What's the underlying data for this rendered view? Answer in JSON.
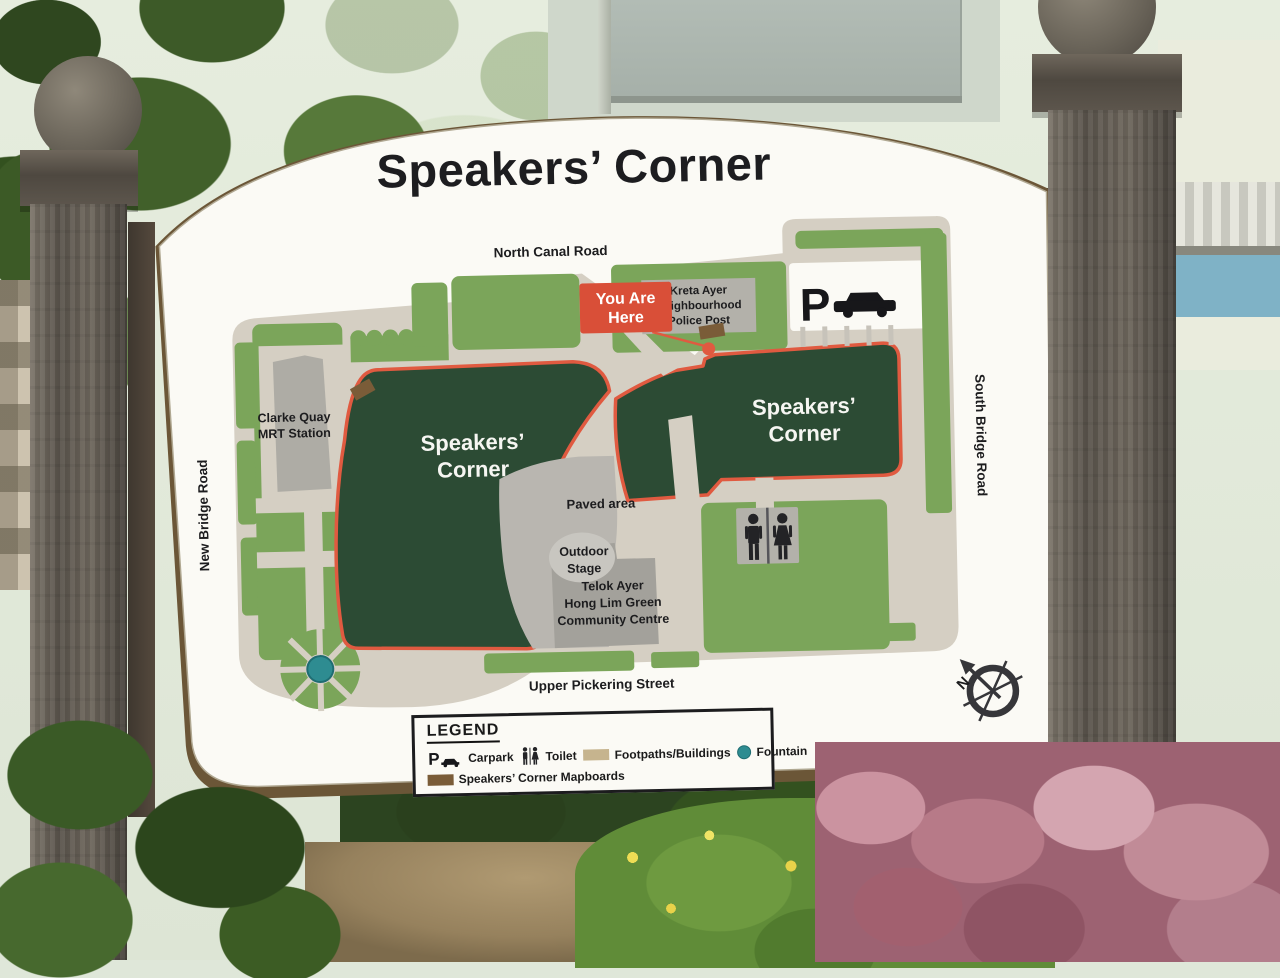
{
  "theme": {
    "paper": "#fbfaf5",
    "beige": "#d5cfc3",
    "lawn": "#7ba55a",
    "field": "#2c4b34",
    "route": "#e05a40",
    "teal": "#2e8c91",
    "paved": "#b9b6b0",
    "bldg": "#a3a19b",
    "greybox": "#b3b1aa",
    "brown": "#7a5c38",
    "tan": "#c6b48e",
    "ink": "#1d1d20",
    "rim": "#6b5637"
  },
  "sign": {
    "title": "Speakers’ Corner"
  },
  "map": {
    "roads": {
      "north": "North Canal Road",
      "west": "New Bridge Road",
      "east": "South Bridge Road",
      "south": "Upper Pickering Street"
    },
    "you_are_here": {
      "line1": "You Are",
      "line2": "Here"
    },
    "police_post": {
      "line1": "Kreta Ayer",
      "line2": "Neighbourhood",
      "line3": "Police Post"
    },
    "mrt": {
      "line1": "Clarke Quay",
      "line2": "MRT Station"
    },
    "field_left": {
      "line1": "Speakers’",
      "line2": "Corner"
    },
    "field_right": {
      "line1": "Speakers’",
      "line2": "Corner"
    },
    "paved_area": "Paved area",
    "stage": {
      "line1": "Outdoor",
      "line2": "Stage"
    },
    "community_centre": {
      "line1": "Telok Ayer",
      "line2": "Hong Lim Green",
      "line3": "Community Centre"
    },
    "carpark_letter": "P",
    "compass_n": "N"
  },
  "legend": {
    "heading": "LEGEND",
    "items": [
      {
        "label": "Carpark"
      },
      {
        "label": "Toilet"
      },
      {
        "label": "Footpaths/Buildings"
      },
      {
        "label": "Fountain"
      },
      {
        "label": "Speakers’ Corner Mapboards"
      }
    ]
  }
}
